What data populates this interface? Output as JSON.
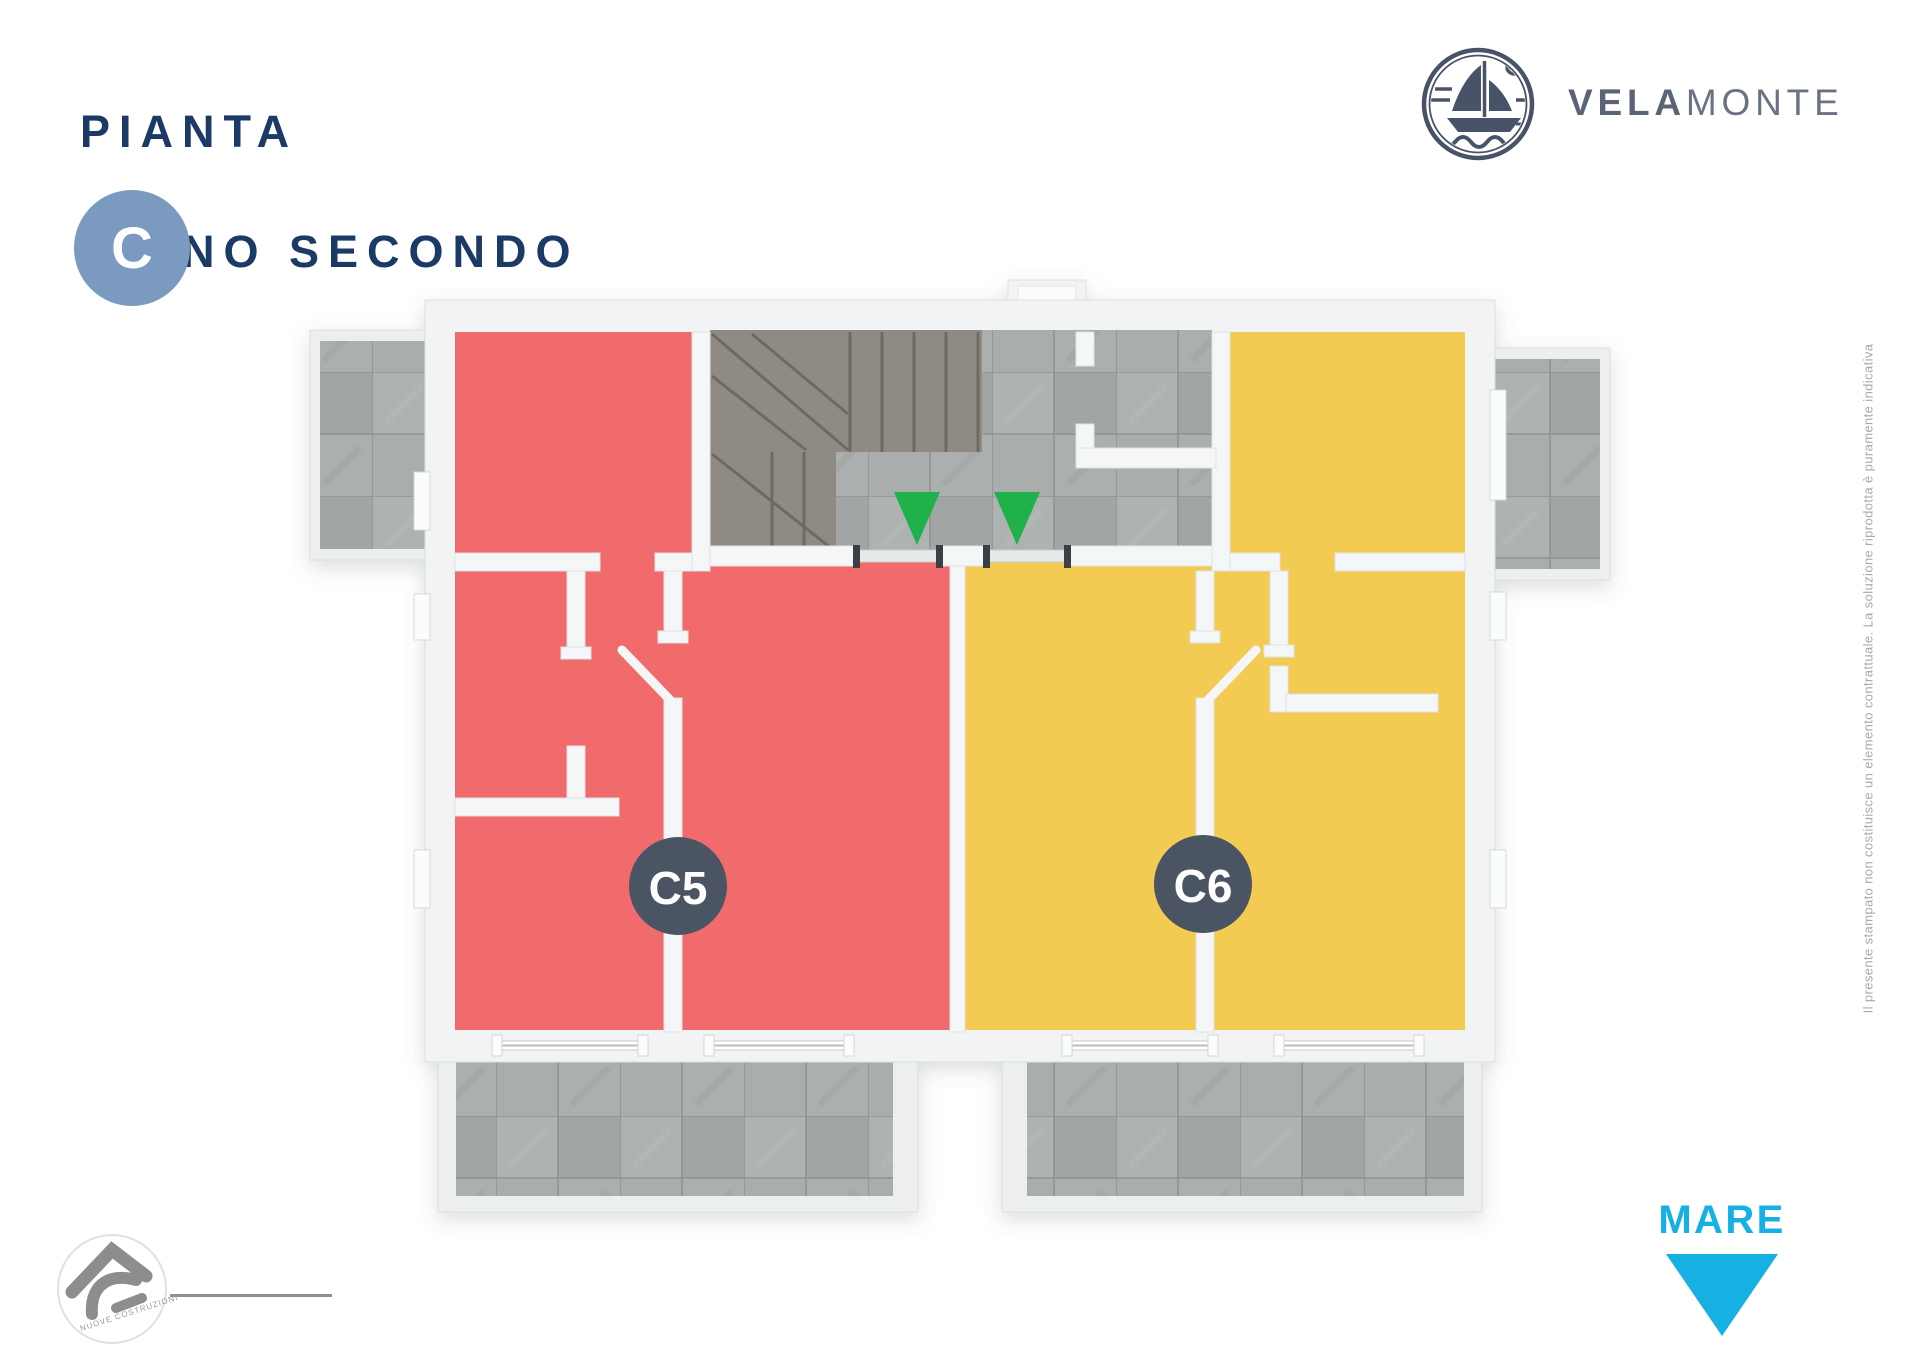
{
  "header": {
    "title_line1": "PIANTA",
    "title_line2": "PIANO SECONDO",
    "block_badge": "C"
  },
  "brand": {
    "wordmark_bold": "VELA",
    "wordmark_light": "MONTE",
    "logo_icon": "sailboat-sun-waves-badge"
  },
  "plan": {
    "units": [
      {
        "label": "C5",
        "color": "#f16b6c",
        "side": "left"
      },
      {
        "label": "C6",
        "color": "#f3ca52",
        "side": "right"
      }
    ],
    "unit_badge_color": "#4a5462",
    "entrance_arrow_color": "#1fb14a",
    "entrance_arrow_count": 2
  },
  "footer": {
    "sea_label": "MARE",
    "sea_color": "#16b1e2",
    "builder_arc_text": "NUOVE COSTRUZIONI"
  },
  "disclaimer_vertical": "Il presente stampato non costituisce un elemento contrattuale. La soluzione riprodotta è puramente indicativa",
  "colors": {
    "title_navy": "#1b3a66",
    "block_badge_blue": "#7b9abf",
    "brand_slate": "#5b6477",
    "wall_white": "#f1f3f4",
    "tile_gray": "#a7abaa",
    "stair_carpet": "#8f8a84",
    "disclaimer_gray": "#a7a9ad"
  }
}
